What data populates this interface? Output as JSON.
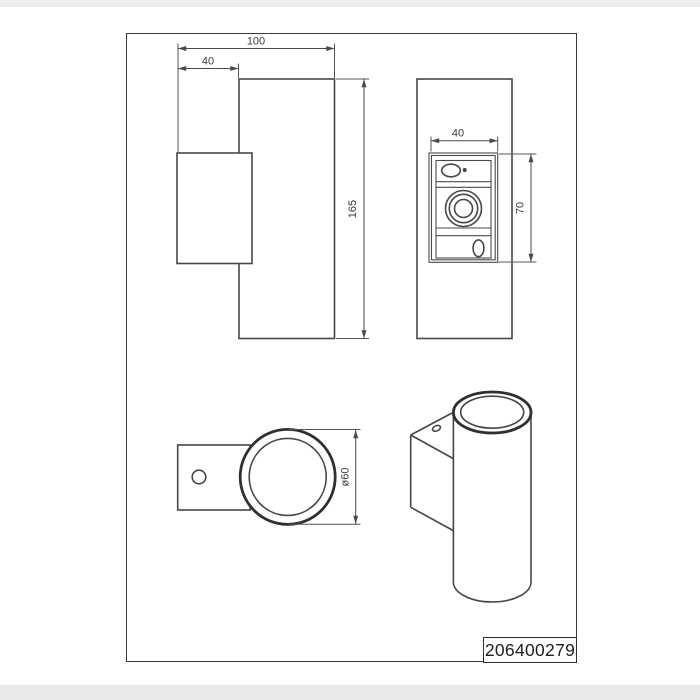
{
  "part_number": "206400279",
  "dimensions": {
    "side": {
      "total_width": "100",
      "bracket_width": "40",
      "height": "165"
    },
    "front": {
      "plate_width": "40",
      "plate_height": "70"
    },
    "top": {
      "diameter": "ø60"
    }
  },
  "colors": {
    "line": "#474747",
    "dim_line": "#4a4a4a",
    "label_text": "#3a3a3a",
    "frame": "#3a3a3a",
    "background": "#ffffff",
    "margin_strip": "#ededed"
  }
}
